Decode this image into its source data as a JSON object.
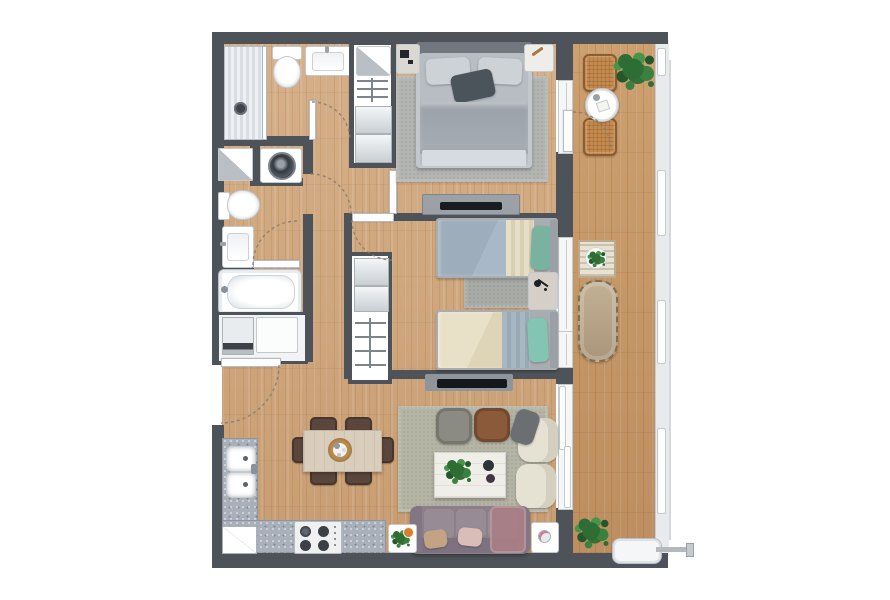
{
  "document": {
    "type": "apartment-floor-plan-rendering",
    "visible_text": "",
    "orientation": "top-down",
    "balcony_side": "right"
  },
  "palette": {
    "wall": "#4d5359",
    "wood_floor": "#d0a87e",
    "balcony_floor": "#c79869",
    "kitchen_counter": "#a9b0ba",
    "rug_master": "#b2b5b2",
    "rug_bedroom2": "#a8aba6",
    "rug_living": "#b5b5a6",
    "sofa": "#8c7f89",
    "teal_pillow": "#7ab5a3",
    "wicker": "#c28a4e",
    "plant_green": "#2f6b33",
    "fixture_white": "#ffffff",
    "dark_accent_pillow": "#4b535b",
    "pouf_leather": "#8a5a3b"
  },
  "rooms": [
    {
      "id": "bathroom-1",
      "fixtures": [
        "shower-stall",
        "toilet",
        "washbasin",
        "door-swing"
      ]
    },
    {
      "id": "bathroom-2",
      "fixtures": [
        "tall-cabinet",
        "washing-machine",
        "toilet",
        "washbasin",
        "bathtub",
        "inner-door-swing",
        "hall-door"
      ]
    },
    {
      "id": "laundry-closet",
      "fixtures": [
        "washer-dryer",
        "water-heater-cabinet"
      ]
    },
    {
      "id": "hallway",
      "fixtures": [
        "entry-door-swing"
      ]
    },
    {
      "id": "master-bedroom",
      "fixtures": [
        "double-bed",
        "rug",
        "nightstand-left",
        "nightstand-right",
        "wardrobe-column",
        "dresser-with-tv",
        "balcony-door-swing"
      ]
    },
    {
      "id": "bedroom-2",
      "fixtures": [
        "twin-bed-upper",
        "twin-bed-lower",
        "bedside-table-lamp",
        "rug",
        "wardrobe-closet",
        "door-swing"
      ]
    },
    {
      "id": "kitchen",
      "fixtures": [
        "counter-left-run",
        "counter-bottom-run",
        "double-sink",
        "cooktop-4-burners",
        "refrigerator"
      ]
    },
    {
      "id": "dining-area",
      "fixtures": [
        "dining-table",
        "chair-x6",
        "round-centerpiece-tray"
      ]
    },
    {
      "id": "living-room",
      "fixtures": [
        "wall-tv",
        "rug",
        "pouf-gray",
        "pouf-leather",
        "armchair-with-throw",
        "armchair",
        "coffee-table-with-plant",
        "sofa-with-pillows",
        "side-table-left",
        "side-table-right"
      ]
    },
    {
      "id": "balcony",
      "fixtures": [
        "bistro-chair-upper",
        "round-bistro-table",
        "bistro-chair-lower",
        "corner-plant",
        "slatted-plant-table",
        "wicker-bench",
        "floor-plant",
        "heat-pump-unit",
        "glass-balustrade"
      ]
    }
  ],
  "counts": {
    "bedrooms": 2,
    "bathrooms": 2,
    "dining_chairs": 6,
    "balcony_chairs": 2,
    "plants": 5
  }
}
